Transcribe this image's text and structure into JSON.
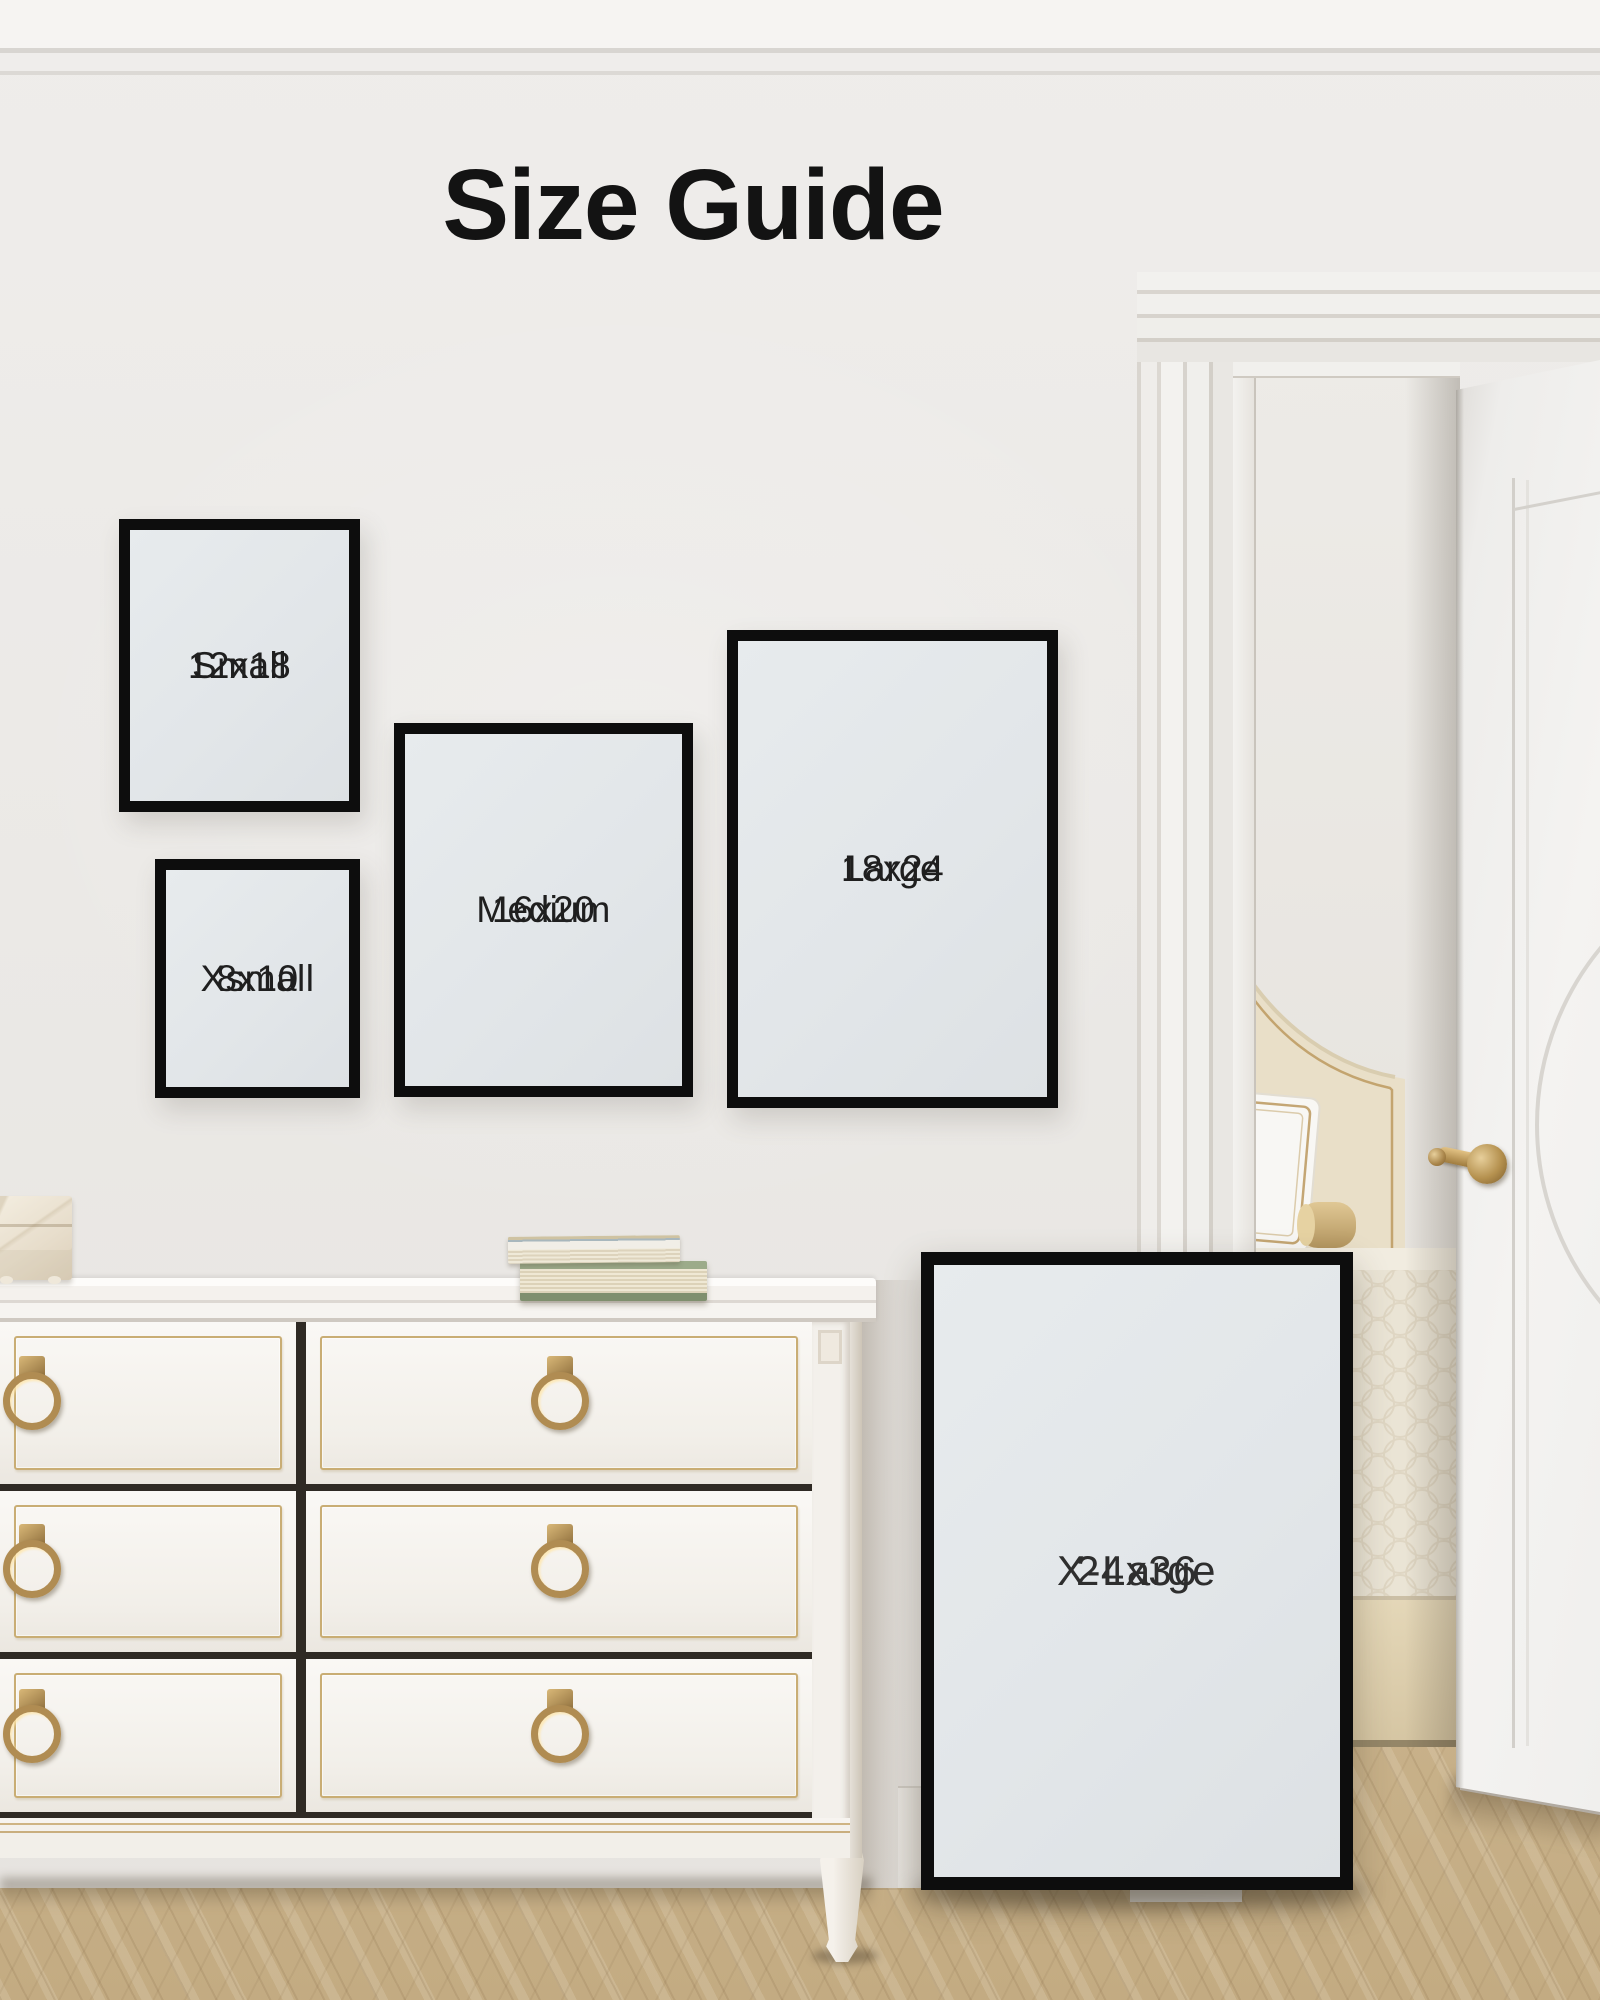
{
  "title": "Size Guide",
  "frames": [
    {
      "label": "Small",
      "size": "12x18"
    },
    {
      "label": "Xsmall",
      "size": "8x10"
    },
    {
      "label": "Medium",
      "size": "16x20"
    },
    {
      "label": "Large",
      "size": "18x24"
    },
    {
      "label": "X-Large",
      "size": "24x36"
    }
  ],
  "colors": {
    "frame_border": "#0d0d0d",
    "frame_fill": "#e4e8ea",
    "title_text": "#131313",
    "label_text": "#1f1f1f",
    "brass_hardware": "#b08c52",
    "gold_trim": "#c9ab6e",
    "wall": "#ebe9e6",
    "floor_wood": "#d3bf9b"
  }
}
